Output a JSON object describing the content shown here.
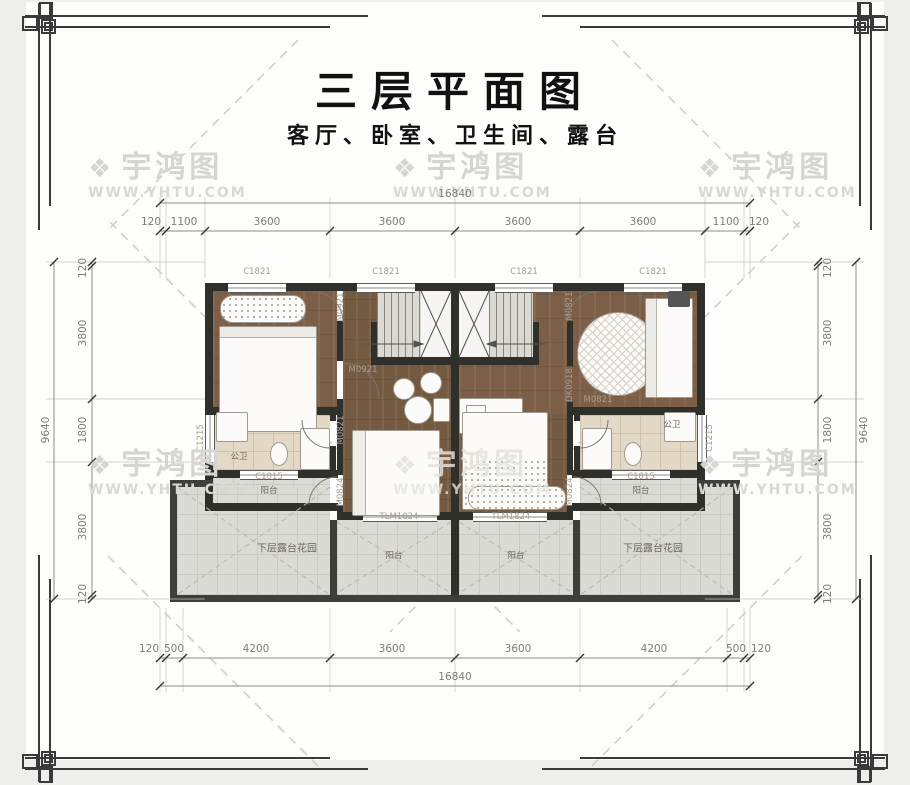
{
  "title": "三层平面图",
  "subtitle": "客厅、卧室、卫生间、露台",
  "watermark": {
    "icon": "❖",
    "brand": "宇鸿图",
    "url": "WWW.YHTU.COM"
  },
  "dims": {
    "top_total": "16840",
    "top_segments": [
      "120",
      "1100",
      "3600",
      "3600",
      "3600",
      "3600",
      "1100",
      "120"
    ],
    "bottom_segments": [
      "120",
      "500",
      "4200",
      "3600",
      "3600",
      "4200",
      "500",
      "120"
    ],
    "bottom_total": "16840",
    "left_total": "9640",
    "left_segments": [
      "120",
      "3800",
      "1800",
      "3800",
      "120"
    ],
    "right_total": "9640",
    "right_segments": [
      "120",
      "3800",
      "1800",
      "3800",
      "120"
    ]
  },
  "plan": {
    "window_top": "C1821",
    "window_side": "C1215",
    "window_balcony": "C1815",
    "door_bedroom": "M0921",
    "door_living": "M0821",
    "door_balcony": "M0824",
    "door_sliding": "TLM1824",
    "opening": "DK0918",
    "room_bath": "公卫",
    "room_balcony": "阳台",
    "room_terrace": "下层露台花园",
    "stair_down": "下"
  }
}
